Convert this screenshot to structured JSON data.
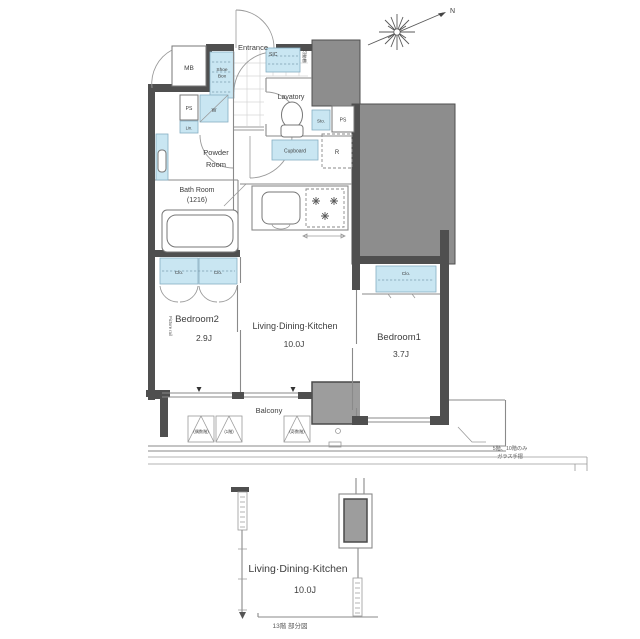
{
  "colors": {
    "fixture_blue": "#c9e6f2",
    "wall_dark": "#4f4f4f",
    "block_gray": "#8d8d8d",
    "pillar_gray": "#9d9d9d",
    "line_gray": "#8a8a8a",
    "text": "#3d3d3d"
  },
  "compass": {
    "north_label": "N"
  },
  "main_plan": {
    "entrance": {
      "label": "Entrance"
    },
    "mb": {
      "label": "MB"
    },
    "shoe_box": {
      "line1": "Shoe",
      "line2": "Box"
    },
    "sic": {
      "label": "SIC",
      "shelf_note": "可動棚"
    },
    "lavatory": {
      "label": "Lavatory"
    },
    "ps_left": {
      "label": "PS"
    },
    "washer": {
      "label": "W"
    },
    "linen": {
      "label": "Lin."
    },
    "storage": {
      "label": "Sto."
    },
    "ps_right": {
      "label": "PS"
    },
    "cupboard": {
      "label": "Cupboard"
    },
    "refrigerator": {
      "label": "R"
    },
    "powder_room": {
      "line1": "Powder",
      "line2": "Room"
    },
    "bath_room": {
      "line1": "Bath Room",
      "line2": "(1216)"
    },
    "closet2_left": {
      "label": "Clo."
    },
    "closet2_right": {
      "label": "Clo."
    },
    "closet1": {
      "label": "Clo."
    },
    "picture_rail": {
      "label": "Picture rail"
    },
    "bedroom2": {
      "label": "Bedroom2",
      "size": "2.9J"
    },
    "ldk": {
      "label": "Living·Dining·Kitchen",
      "size": "10.0J"
    },
    "bedroom1": {
      "label": "Bedroom1",
      "size": "3.7J"
    },
    "balcony": {
      "label": "Balcony"
    },
    "ac_spaces": {
      "left": "(偶数階)",
      "middle": "(1階)",
      "right": "(奇数階)"
    },
    "note": {
      "line1": "5階、10階のみ",
      "line2": "ガラス手摺"
    }
  },
  "partial_plan": {
    "ldk": {
      "label": "Living·Dining·Kitchen",
      "size": "10.0J"
    },
    "caption": "13階 部分図"
  }
}
